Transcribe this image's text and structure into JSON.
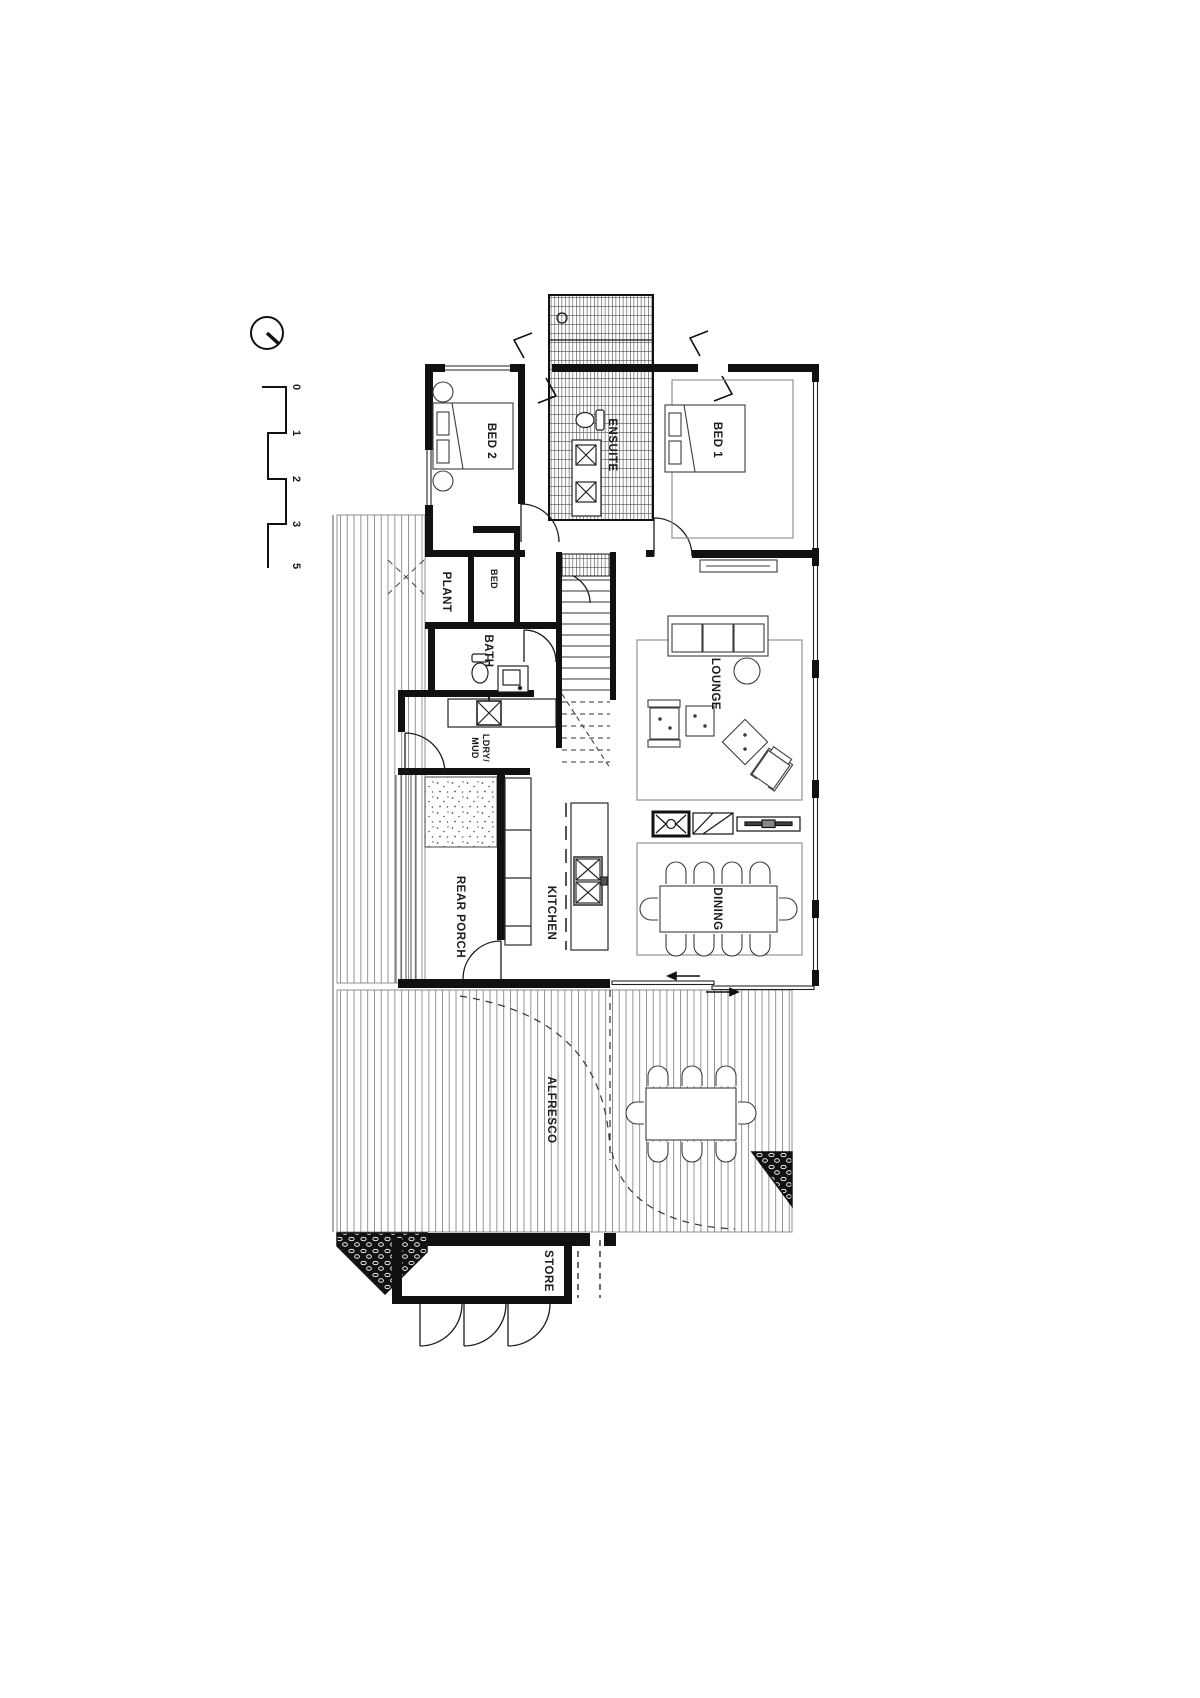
{
  "drawing": {
    "type": "architectural-floor-plan",
    "note": "ground floor plan, drawing rotated 90 degrees on page"
  },
  "compass": {
    "icon": "north-arrow"
  },
  "scale_bar": {
    "labels": [
      "0",
      "1",
      "2",
      "3",
      "5"
    ]
  },
  "rooms": {
    "bed2": "BED 2",
    "ensuite": "ENSUITE",
    "bed1": "BED 1",
    "plant": "PLANT",
    "bed_cupboard": "BED",
    "bath": "BATH",
    "laundry_line1": "LDRY/",
    "laundry_line2": "MUD",
    "lounge": "LOUNGE",
    "kitchen": "KITCHEN",
    "rear_porch": "REAR PORCH",
    "dining": "DINING",
    "alfresco": "ALFRESCO",
    "store": "STORE"
  },
  "colors": {
    "ink": "#1b1b1b",
    "paper": "#ffffff",
    "board_line": "#828282",
    "furniture_line": "#3d3d3d",
    "rug_line": "#8a8a8a"
  }
}
